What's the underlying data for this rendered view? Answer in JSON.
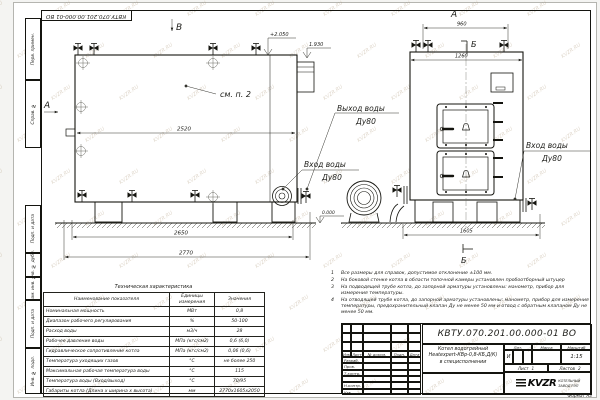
{
  "watermark": {
    "text": "KVZR.RU"
  },
  "frame": {
    "doc_number_top": "КВТУ.070.201.00.000-01 ВО",
    "margin_boxes": [
      "Перв. примен.",
      "Справ. №",
      "Подп. и дата",
      "Инв. № дубл.",
      "Взам. инв. №",
      "Подп. и дата",
      "Инв. № подл."
    ],
    "format_label": "Формат А3"
  },
  "views": {
    "side": {
      "label_top": "В",
      "label_left": "А",
      "elevation_top": "+2.050",
      "elevation_step": "1.930",
      "note_ref": "см. п. 2",
      "dim_width": "2520",
      "dim_base": "2650",
      "dim_overall": "2770",
      "elevation_zero": "0.000"
    },
    "front": {
      "label_top": "А",
      "section_label_top": "Б",
      "dim_top": "960",
      "dim_width": "1260",
      "dim_overall": "1605",
      "section_label_bottom": "Б"
    },
    "labels": {
      "outlet_line1": "Выход воды",
      "outlet_line2": "Ду80",
      "inlet1_line1": "Вход воды",
      "inlet1_line2": "Ду80",
      "inlet2_line1": "Вход воды",
      "inlet2_line2": "Ду80"
    }
  },
  "tech_table": {
    "title": "Техническая характеристика",
    "headers": [
      "Наименование показателя",
      "Единицы измерения",
      "Значения"
    ],
    "rows": [
      [
        "Номинальная мощность",
        "МВт",
        "0,8"
      ],
      [
        "Диапазон рабочего регулирования",
        "%",
        "50-100"
      ],
      [
        "Расход воды",
        "м3/ч",
        "28"
      ],
      [
        "Рабочее давление воды",
        "МПа (кгс/см2)",
        "0,6 (6,0)"
      ],
      [
        "Гидравлическое сопротивление котла",
        "МПа (кгс/см2)",
        "0,06 (0,6)"
      ],
      [
        "Температура уходящих газов",
        "°С",
        "не более 250"
      ],
      [
        "Максимальная рабочая температура воды",
        "°С",
        "115"
      ],
      [
        "Температура воды (Вход/выход)",
        "°С",
        "70/95"
      ],
      [
        "Габариты котла (Длина х ширина х высота)",
        "мм",
        "2770х1605х2050"
      ]
    ]
  },
  "notes": {
    "items": [
      {
        "num": "1",
        "text": "Все размеры для справок, допустимое отклонение ±100 мм."
      },
      {
        "num": "2",
        "text": "На боковой стенке котла в области топочной камеры установлен пробоотборный штуцер"
      },
      {
        "num": "3",
        "text": "На подводящей трубе котла, до запорной арматуры установлены: манометр, прибор для измерения температуры."
      },
      {
        "num": "4",
        "text": "На отводящей трубе котла, до запорной арматуры установлены: манометр, прибор для измерения температуры, предохранительный клапан Ду не менее 50 мм и отвод с обратным клапаном Ду не менее 50 мм."
      }
    ]
  },
  "title_block": {
    "doc_number": "КВТУ.070.201.00.000-01 ВО",
    "title_line1": "Котел водогрейный",
    "title_line2": "Heatexpert-КВр-0,8-КБ,Д(К)",
    "title_line3": "в специсполнении",
    "rev_headers": [
      "Изм.",
      "Лист",
      "№ докум.",
      "Подп.",
      "Дата"
    ],
    "sign_rows": [
      "Разраб.",
      "Пров.",
      "Т.контр.",
      "",
      "Н.контр.",
      "Утв."
    ],
    "lit_header": "Лит.",
    "mass_header": "Масса",
    "scale_header": "Масштаб",
    "lit_value": "И",
    "scale_value": "1:15",
    "sheet_label": "Лист",
    "sheet_value": "1",
    "sheets_label": "Листов",
    "sheets_value": "2",
    "logo_text": "KVZR",
    "logo_sub1": "КОТЕЛЬНЫЙ",
    "logo_sub2": "ЗАВОД РЭП"
  }
}
